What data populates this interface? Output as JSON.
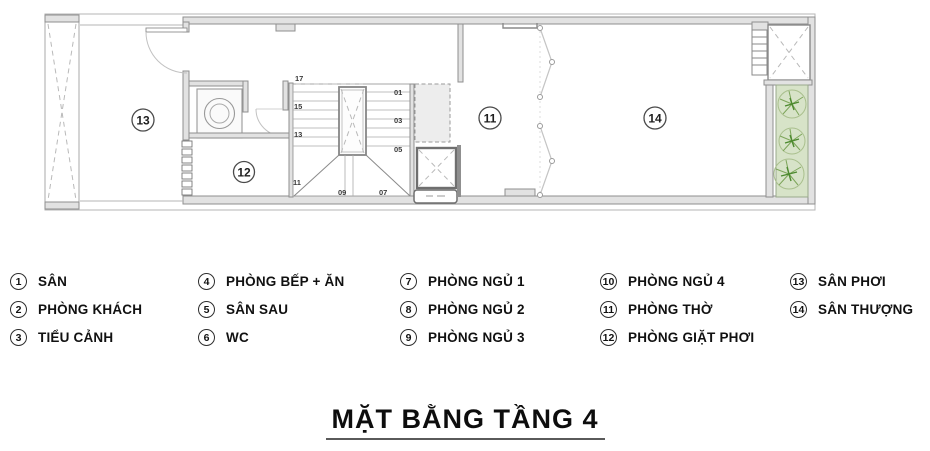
{
  "title": "MẶT BẰNG TẦNG 4",
  "colors": {
    "text": "#111111",
    "wall_fill": "#e2e2e2",
    "wall_stroke": "#8f8f8f",
    "planter_fill": "#d7e3c8",
    "plant_stroke": "#7da55a",
    "plant_dark": "#4c8a2f"
  },
  "plan": {
    "room_labels": [
      {
        "num": "13",
        "x": 143,
        "y": 120
      },
      {
        "num": "12",
        "x": 244,
        "y": 172
      },
      {
        "num": "11",
        "x": 490,
        "y": 118
      },
      {
        "num": "14",
        "x": 655,
        "y": 118
      }
    ],
    "stair_numbers": [
      {
        "t": "17",
        "x": 295,
        "y": 81
      },
      {
        "t": "15",
        "x": 294,
        "y": 109
      },
      {
        "t": "13",
        "x": 294,
        "y": 137
      },
      {
        "t": "11",
        "x": 293,
        "y": 185
      },
      {
        "t": "09",
        "x": 338,
        "y": 195
      },
      {
        "t": "07",
        "x": 379,
        "y": 195
      },
      {
        "t": "05",
        "x": 394,
        "y": 152
      },
      {
        "t": "03",
        "x": 394,
        "y": 123
      },
      {
        "t": "01",
        "x": 394,
        "y": 95
      }
    ]
  },
  "legend": {
    "columns": [
      {
        "items": [
          {
            "num": "1",
            "label": "SÂN"
          },
          {
            "num": "2",
            "label": "PHÒNG KHÁCH"
          },
          {
            "num": "3",
            "label": "TIỂU CẢNH"
          }
        ]
      },
      {
        "items": [
          {
            "num": "4",
            "label": "PHÒNG BẾP + ĂN"
          },
          {
            "num": "5",
            "label": "SÂN SAU"
          },
          {
            "num": "6",
            "label": "WC"
          }
        ]
      },
      {
        "items": [
          {
            "num": "7",
            "label": "PHÒNG NGỦ 1"
          },
          {
            "num": "8",
            "label": "PHÒNG NGỦ 2"
          },
          {
            "num": "9",
            "label": "PHÒNG NGỦ 3"
          }
        ]
      },
      {
        "items": [
          {
            "num": "10",
            "label": "PHÒNG NGỦ 4"
          },
          {
            "num": "11",
            "label": "PHÒNG THỜ"
          },
          {
            "num": "12",
            "label": "PHÒNG GIẶT PHƠI"
          }
        ]
      },
      {
        "items": [
          {
            "num": "13",
            "label": "SÂN PHƠI"
          },
          {
            "num": "14",
            "label": "SÂN THƯỢNG"
          }
        ]
      }
    ]
  }
}
